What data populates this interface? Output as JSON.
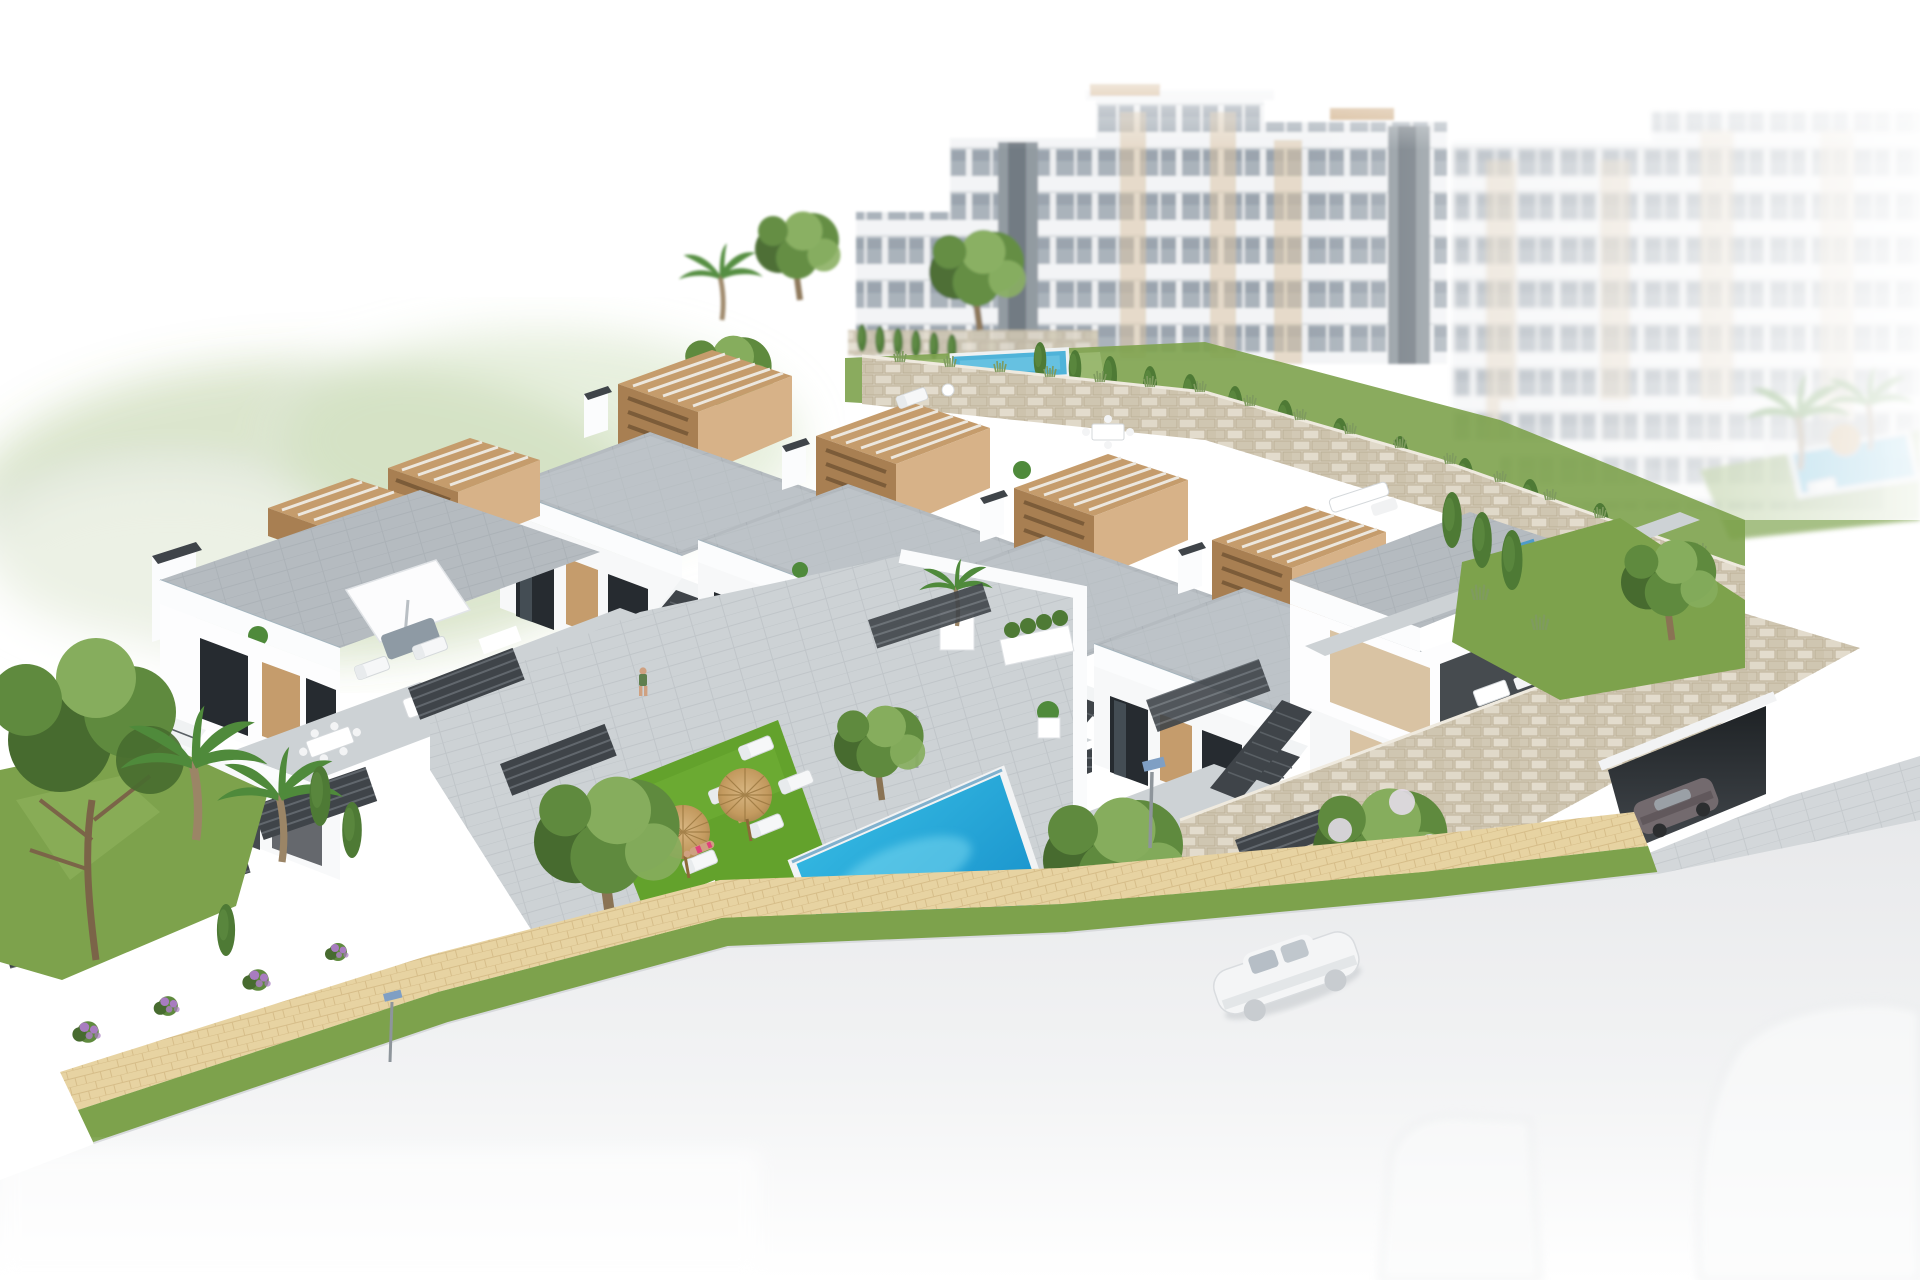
{
  "scene": {
    "kind": "architectural-3d-render",
    "title": "Aerial render of a new-build white residential complex with communal pool",
    "canvas": {
      "width": 1920,
      "height": 1280
    },
    "inventory": {
      "background_apartment_towers": 6,
      "townhouse_units_in_row": 4,
      "end_block_with_garage": 1,
      "detached_villa_left": 1,
      "communal_pool": 1,
      "lap_pool_upper_level": 1,
      "background_garden_pool": 1,
      "straw_parasols": 2,
      "white_roof_parasol": 1,
      "sun_loungers_white": 9,
      "sun_loungers_blue_roof": 3,
      "people": {
        "balcony_walker": 1,
        "sunbather": 1,
        "swimmer_in_pool": 1
      },
      "cars": {
        "white_on_road": 1,
        "dark_at_garage": 1,
        "faded_parked_bottom": 2
      },
      "street_lamps": 2,
      "palm_trees": 6,
      "cypress_trees": 14,
      "round_trees": 7,
      "purple_flower_shrubs": 6
    }
  },
  "colors": {
    "bg": "#ffffff",
    "haze_green": "#e3ecd7",
    "building_white": "#f6f7f8",
    "building_shadow": "#e6e9ec",
    "glass_gray": "#a2acb5",
    "glass_dark": "#262b30",
    "tan_panel": "#d9c3a3",
    "pergola_wood": "#c59c6c",
    "pergola_wood_dark": "#a87f52",
    "pergola_wood_light": "#d7b288",
    "terrace_gray": "#b5bbc0",
    "terrace_gray_light": "#cdd2d5",
    "parapet_white": "#fbfcfd",
    "slat_dark": "#3f4449",
    "stone_wall": "#d7cfbd",
    "stone_wall_light": "#e0d9c9",
    "lawn_green": "#7da24c",
    "lawn_bright": "#63a22c",
    "cypress_green": "#4e7a35",
    "tree_green": "#5f8a3e",
    "tree_green_light": "#86ad5d",
    "tree_green_dark": "#476b2f",
    "palm_green": "#4f8a3b",
    "pool_water_light": "#3cc3e8",
    "pool_water_deep": "#0f85c4",
    "lap_pool_blue": "#4fb3d9",
    "parasol_straw": "#c9a169",
    "parasol_straw_dark": "#a9854f",
    "path_tan": "#e7d3a2",
    "path_joint": "#c9ab74",
    "road_gray": "#e8e9eb",
    "white_car": "#f4f5f6",
    "car_glass": "#b6bec6",
    "dark_car": "#736a6e",
    "flower_purple": "#a87cc0",
    "skin_tone": "#cfa181",
    "bikini_pink": "#e0427a",
    "lamp_solar_blue": "#7f9fc4",
    "shadow_soft": "#9aa29b"
  }
}
